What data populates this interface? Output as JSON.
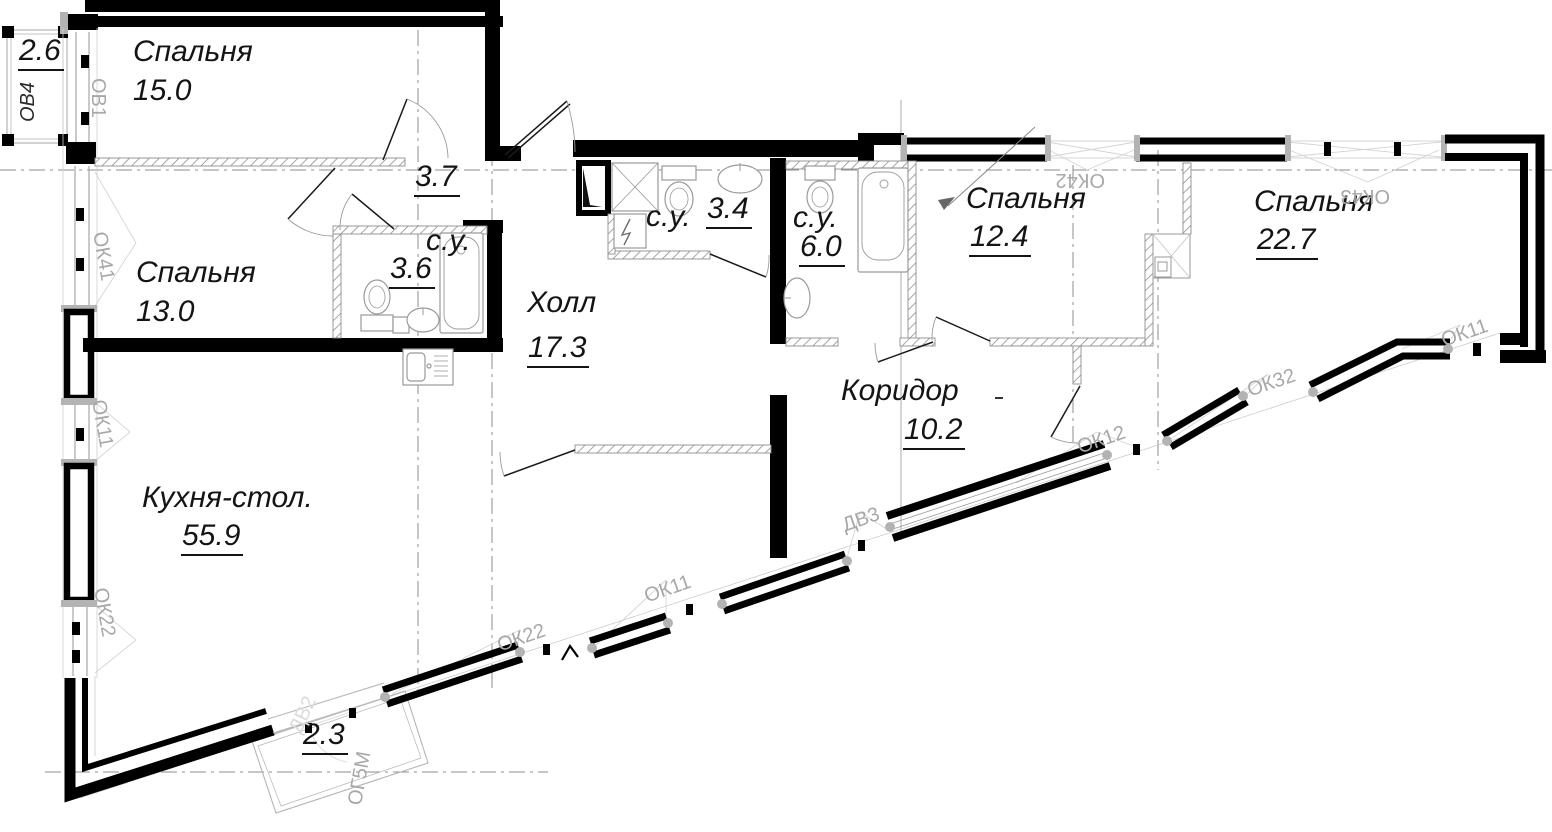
{
  "title": "apartment-floor-plan",
  "colors": {
    "wall": "#000000",
    "partition_hatch": "#8f8f8f",
    "window_code_gray": "#a8a8a8",
    "axis_gray": "#8c8c8c",
    "fixture_gray": "#9a9a9a",
    "balcony_gray": "#b5b5b5",
    "text_black": "#141414"
  },
  "plan": {
    "rooms": [
      {
        "id": "bedroom-1",
        "name": "Спальня",
        "area": "15.0",
        "u": false,
        "nx": 133,
        "ny": 37,
        "ax": 133,
        "ay": 76
      },
      {
        "id": "bedroom-2",
        "name": "Спальня",
        "area": "13.0",
        "u": false,
        "nx": 136,
        "ny": 258,
        "ax": 136,
        "ay": 297
      },
      {
        "id": "kitchen-dining",
        "name": "Кухня-стол.",
        "area": "55.9",
        "u": true,
        "nx": 142,
        "ny": 483,
        "ax": 181,
        "ay": 521
      },
      {
        "id": "hall",
        "name": "Холл",
        "area": "17.3",
        "u": true,
        "nx": 527,
        "ny": 288,
        "ax": 527,
        "ay": 333
      },
      {
        "id": "corridor",
        "name": "Коридор",
        "area": "10.2",
        "u": true,
        "nx": 841,
        "ny": 376,
        "ax": 903,
        "ay": 415
      },
      {
        "id": "bedroom-3",
        "name": "Спальня",
        "area": "12.4",
        "u": true,
        "nx": 966,
        "ny": 184,
        "ax": 969,
        "ay": 222
      },
      {
        "id": "bedroom-4",
        "name": "Спальня",
        "area": "22.7",
        "u": true,
        "nx": 1254,
        "ny": 187,
        "ax": 1256,
        "ay": 225
      },
      {
        "id": "bathroom-1",
        "name": "с.у.",
        "area": "3.6",
        "u": true,
        "nx": 426,
        "ny": 226,
        "ax": 389,
        "ay": 254
      },
      {
        "id": "bathroom-2",
        "name": "с.у.",
        "area": "3.4",
        "u": true,
        "nx": 646,
        "ny": 202,
        "ax": 706,
        "ay": 194
      },
      {
        "id": "bathroom-3",
        "name": "с.у.",
        "area": "6.0",
        "u": true,
        "nx": 793,
        "ny": 203,
        "ax": 799,
        "ay": 232
      },
      {
        "id": "lobby",
        "name": "",
        "area": "3.7",
        "u": true,
        "nx": 0,
        "ny": 0,
        "ax": 414,
        "ay": 162
      },
      {
        "id": "balcony-1",
        "name": "",
        "area": "2.6",
        "u": true,
        "nx": 0,
        "ny": 0,
        "ax": 18,
        "ay": 36
      },
      {
        "id": "balcony-2",
        "name": "",
        "area": "2.3",
        "u": true,
        "nx": 0,
        "ny": 0,
        "ax": 302,
        "ay": 720
      }
    ],
    "marks": [
      {
        "text": "ОВ4",
        "x": 28,
        "y": 112,
        "rot": -90,
        "shade": "dark"
      },
      {
        "text": "ОВ1",
        "x": 98,
        "y": 68,
        "rot": 90,
        "shade": ""
      },
      {
        "text": "ОК41",
        "x": 99,
        "y": 222,
        "rot": 80,
        "shade": ""
      },
      {
        "text": "ОК11",
        "x": 98,
        "y": 390,
        "rot": 80,
        "shade": ""
      },
      {
        "text": "ОК22",
        "x": 100,
        "y": 578,
        "rot": 80,
        "shade": ""
      },
      {
        "text": "ОК22",
        "x": 498,
        "y": 636,
        "rot": -19,
        "shade": ""
      },
      {
        "text": "ОК11",
        "x": 645,
        "y": 587,
        "rot": -19,
        "shade": ""
      },
      {
        "text": "ДВ3",
        "x": 843,
        "y": 516,
        "rot": -19,
        "shade": ""
      },
      {
        "text": "ОК12",
        "x": 1078,
        "y": 438,
        "rot": -19,
        "shade": ""
      },
      {
        "text": "ОК32",
        "x": 1248,
        "y": 381,
        "rot": -19,
        "shade": ""
      },
      {
        "text": "ОК11",
        "x": 1442,
        "y": 331,
        "rot": -19,
        "shade": ""
      },
      {
        "text": "ОК42",
        "x": 1105,
        "y": 170,
        "rot": 180,
        "shade": ""
      },
      {
        "text": "ОК43",
        "x": 1390,
        "y": 186,
        "rot": 180,
        "shade": ""
      },
      {
        "text": "ОГ5М",
        "x": 355,
        "y": 795,
        "rot": -80,
        "shade": ""
      },
      {
        "text": "ДВ2",
        "x": 295,
        "y": 722,
        "rot": -65,
        "shade": "faint"
      }
    ]
  }
}
